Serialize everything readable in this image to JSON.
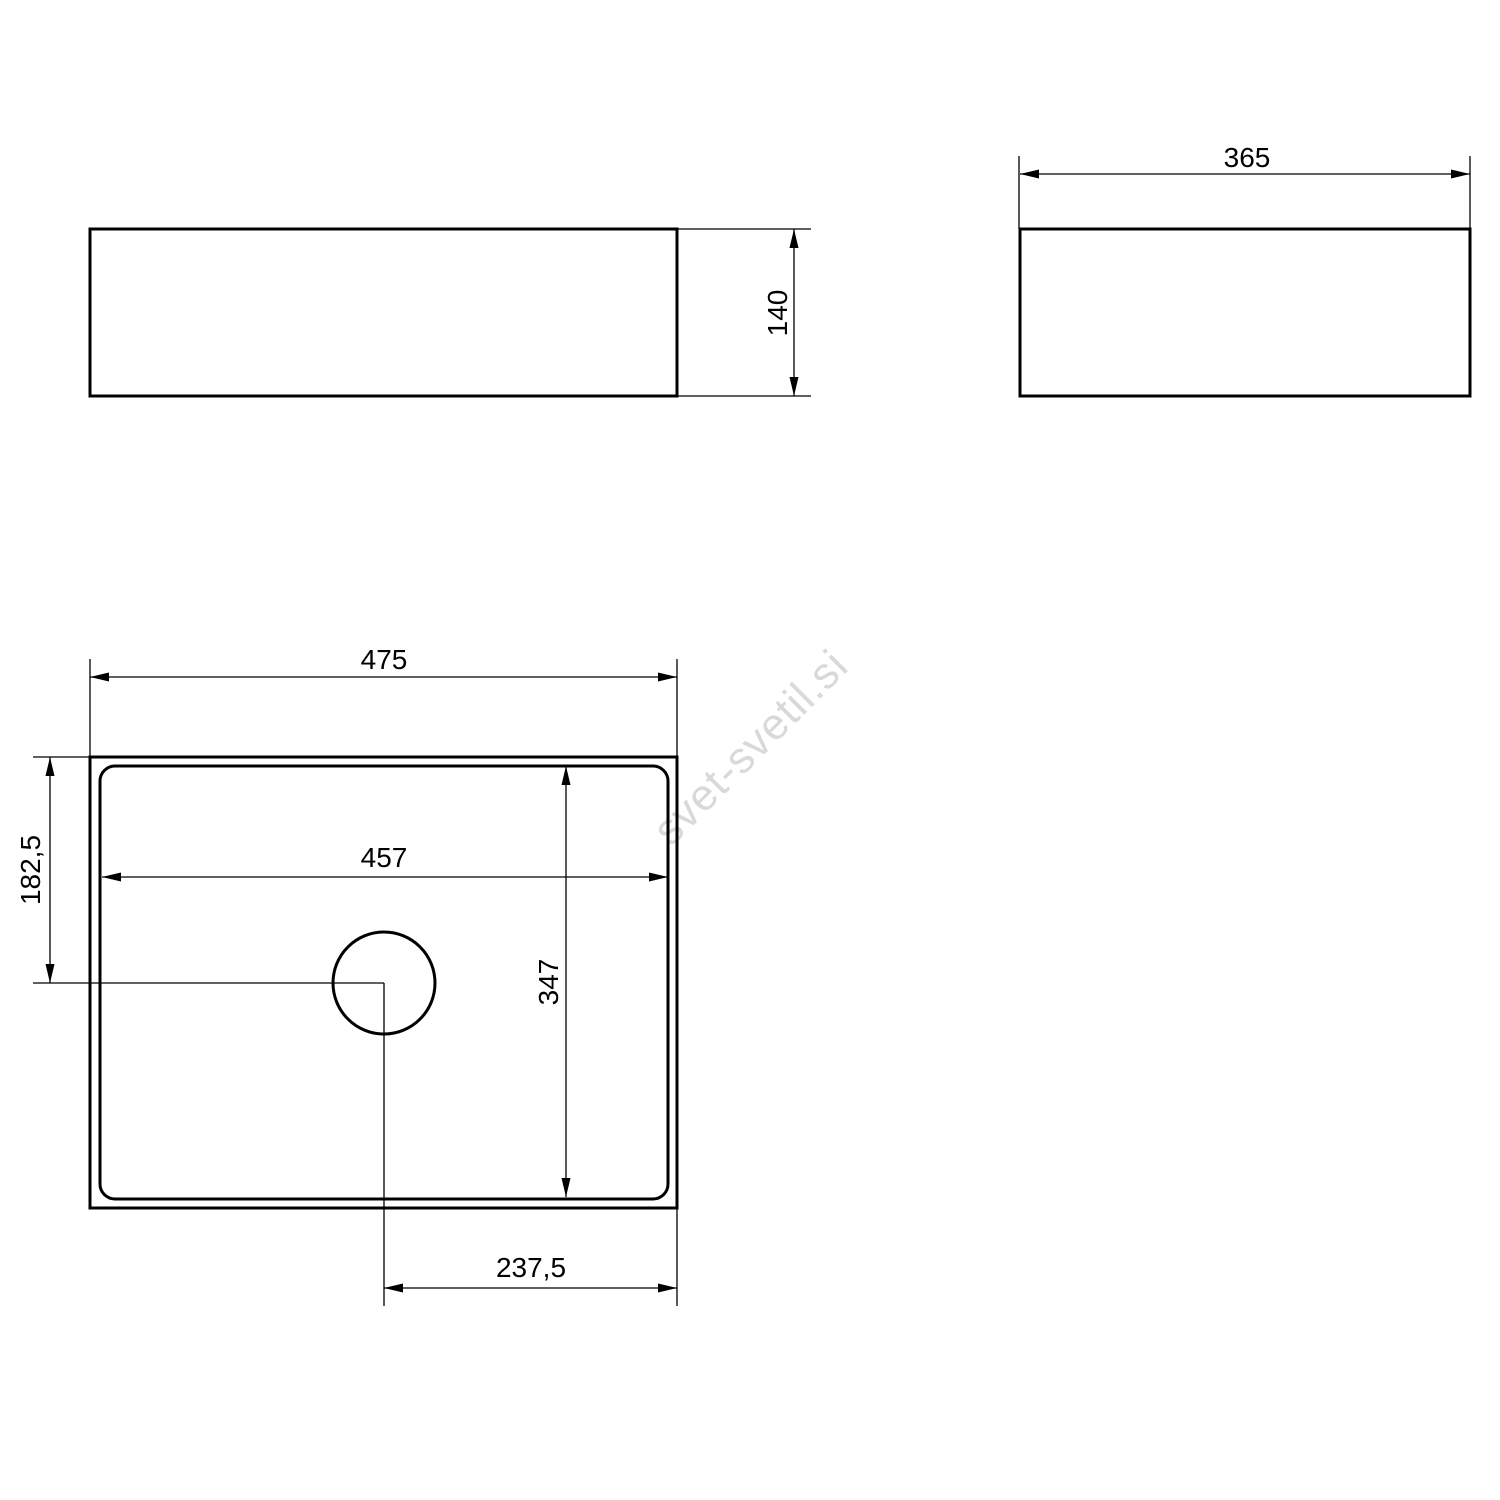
{
  "drawing": {
    "background": "#ffffff",
    "line_color": "#000000",
    "text_color": "#000000"
  },
  "dimensions": {
    "front_height": "140",
    "side_width": "365",
    "plan_outer_width": "475",
    "plan_inner_width": "457",
    "drain_center_from_top": "182,5",
    "plan_inner_height": "347",
    "drain_center_from_right": "237,5"
  },
  "watermark": {
    "text": "svet-svetil.si",
    "color": "#d9d9d9"
  }
}
